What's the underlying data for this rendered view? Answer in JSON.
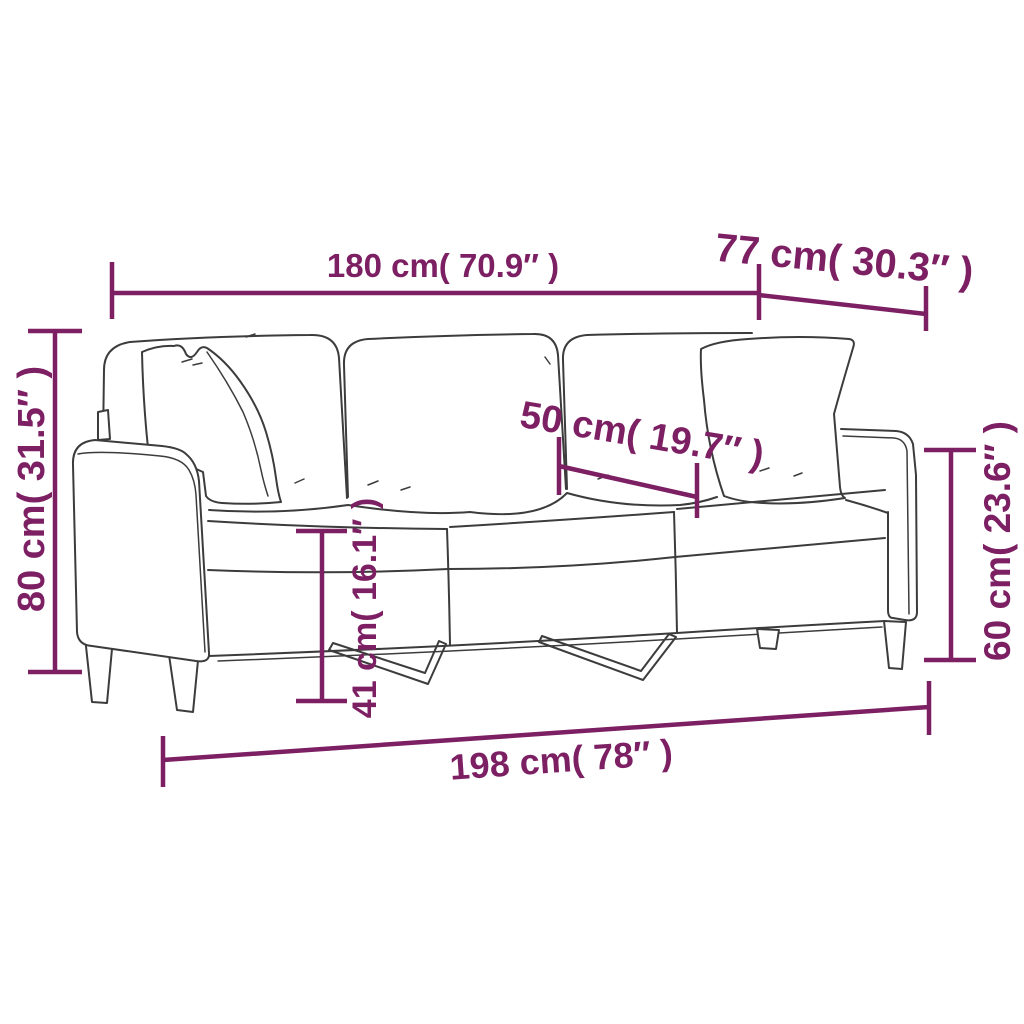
{
  "diagram": {
    "type": "product-dimension-diagram",
    "subject": "3-seater sofa with throw pillows (line drawing)"
  },
  "colors": {
    "measurement": "#7c1f63",
    "line_art": "#3c3c3c",
    "background": "#ffffff"
  },
  "measurements": [
    {
      "name": "inner-width",
      "label": "180 cm( 70.9″ )"
    },
    {
      "name": "depth",
      "label": "77 cm( 30.3″ )"
    },
    {
      "name": "height",
      "label": "80 cm( 31.5″ )"
    },
    {
      "name": "seat-depth",
      "label": "50 cm( 19.7″ )"
    },
    {
      "name": "seat-height",
      "label": "41 cm( 16.1″ )"
    },
    {
      "name": "arm-height",
      "label": "60 cm( 23.6″ )"
    },
    {
      "name": "total-width",
      "label": "198 cm( 78″ )"
    }
  ]
}
